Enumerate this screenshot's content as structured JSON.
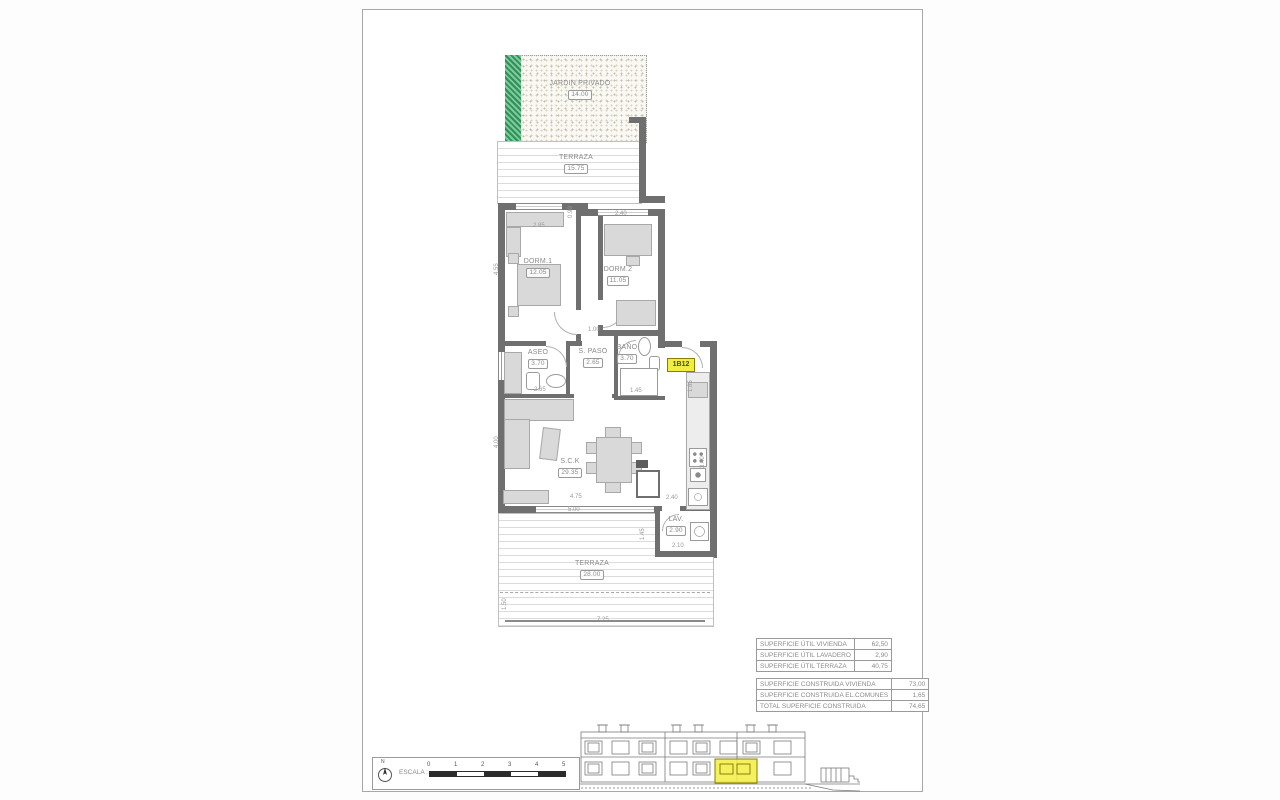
{
  "plan": {
    "garden": {
      "label": "JARDIN PRIVADO",
      "area": "14.00"
    },
    "terrace_top": {
      "label": "TERRAZA",
      "area": "15.75"
    },
    "dorm1": {
      "label": "DORM.1",
      "area": "12.05"
    },
    "dorm2": {
      "label": "DORM.2",
      "area": "11.05"
    },
    "aseo": {
      "label": "ASEO",
      "area": "3.70"
    },
    "paso": {
      "label": "S. PASO",
      "area": "2.65"
    },
    "bano": {
      "label": "BAÑO",
      "area": "3.70"
    },
    "sck": {
      "label": "S.C.K",
      "area": "29.35"
    },
    "lav": {
      "label": "LAV.",
      "area": "2.90"
    },
    "terrace_bottom": {
      "label": "TERRAZA",
      "area": "28.00"
    },
    "unit_tag": "1B12",
    "dims": [
      "2.85",
      "2.40",
      "0.90",
      "1.00",
      "4.55",
      "4.00",
      "2.65",
      "1.45",
      "1.85",
      "4.75",
      "5.00",
      "2.40",
      "2.10",
      "1.45",
      "7.25",
      "1.50",
      "3.40"
    ]
  },
  "tables": {
    "util": {
      "rows": [
        {
          "label": "SUPERFICIE ÚTIL VIVIENDA",
          "value": "62,50"
        },
        {
          "label": "SUPERFICIE ÚTIL LAVADERO",
          "value": "2,90"
        },
        {
          "label": "SUPERFICIE ÚTIL TERRAZA",
          "value": "40,75"
        }
      ]
    },
    "built": {
      "rows": [
        {
          "label": "SUPERFICIE CONSTRUIDA VIVIENDA",
          "value": "73,00"
        },
        {
          "label": "SUPERFICIE CONSTRUIDA EL.COMUNES",
          "value": "1,65"
        },
        {
          "label": "TOTAL SUPERFICIE CONSTRUIDA",
          "value": "74,65"
        }
      ]
    }
  },
  "scale": {
    "label": "ESCALA :",
    "north": "N",
    "ticks": [
      "0",
      "1",
      "2",
      "3",
      "4",
      "5"
    ]
  },
  "colors": {
    "wall": "#6f6f6f",
    "highlight": "#f2ee3f",
    "garden_green": "#3aa56a",
    "line": "#9a9a9a"
  }
}
